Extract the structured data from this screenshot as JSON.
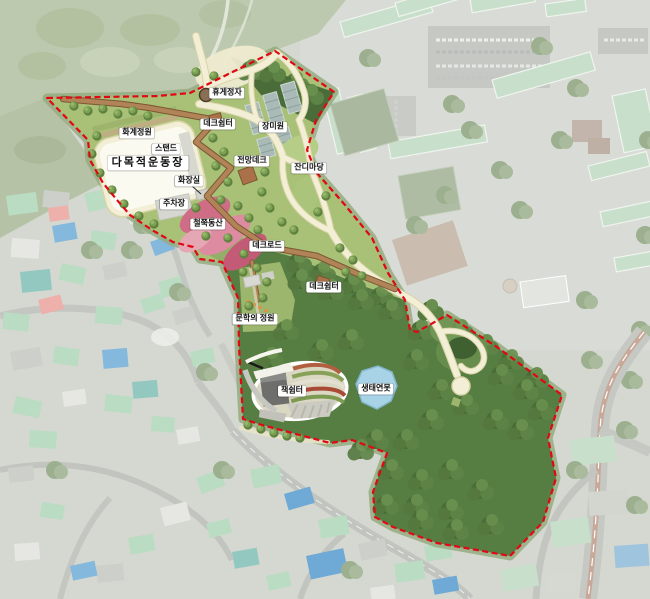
{
  "site_plan": {
    "description": "Park master plan rendered over faded aerial photograph, site outlined with red dashed boundary",
    "colors": {
      "boundary": "#e30613",
      "pond": "#a8d2e6",
      "deck": "#b08457",
      "path": "#f3efd6",
      "forest": "#577e42",
      "lawn": "#a8c176",
      "azalea": "#cf6d86",
      "pavilion": "#8a6f55"
    },
    "labels": [
      {
        "id": "rest-pavilion",
        "text": "휴게정자"
      },
      {
        "id": "deck-shelter-1",
        "text": "데크쉼터"
      },
      {
        "id": "rose-garden",
        "text": "장미원"
      },
      {
        "id": "terraced-flower-garden",
        "text": "화계정원"
      },
      {
        "id": "stand",
        "text": "스탠드"
      },
      {
        "id": "multipurpose-field",
        "text": "다목적운동장"
      },
      {
        "id": "observation-deck",
        "text": "전망데크"
      },
      {
        "id": "lawn-plaza",
        "text": "잔디마당"
      },
      {
        "id": "restroom",
        "text": "화장실"
      },
      {
        "id": "parking-lot",
        "text": "주차장"
      },
      {
        "id": "azalea-hill",
        "text": "철쭉동산"
      },
      {
        "id": "deck-road",
        "text": "데크로드"
      },
      {
        "id": "deck-shelter-2",
        "text": "데크쉼터"
      },
      {
        "id": "literature-garden",
        "text": "문학의 정원"
      },
      {
        "id": "book-shelter",
        "text": "책쉼터"
      },
      {
        "id": "eco-pond",
        "text": "생태연못"
      }
    ]
  }
}
